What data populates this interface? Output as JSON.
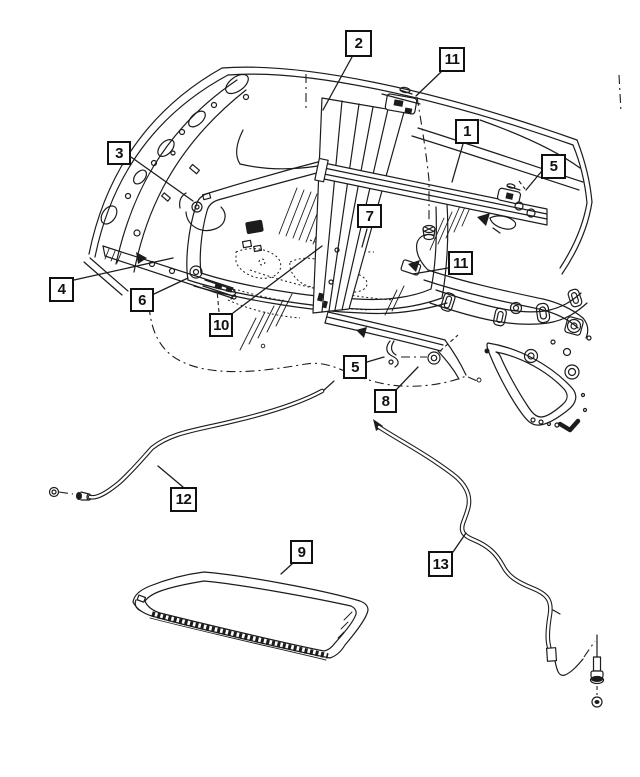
{
  "figure": {
    "title": "Sunroof and roof panel exploded parts diagram",
    "background_color": "#ffffff",
    "line_color": "#1c1c1c",
    "callout_border_color": "#111111"
  },
  "callouts": [
    {
      "id": "2",
      "label": "2"
    },
    {
      "id": "11-top",
      "label": "11"
    },
    {
      "id": "1",
      "label": "1"
    },
    {
      "id": "3",
      "label": "3"
    },
    {
      "id": "5-upper",
      "label": "5"
    },
    {
      "id": "7",
      "label": "7"
    },
    {
      "id": "11-mid",
      "label": "11"
    },
    {
      "id": "4",
      "label": "4"
    },
    {
      "id": "6",
      "label": "6"
    },
    {
      "id": "10",
      "label": "10"
    },
    {
      "id": "5-lower",
      "label": "5"
    },
    {
      "id": "8",
      "label": "8"
    },
    {
      "id": "12",
      "label": "12"
    },
    {
      "id": "9",
      "label": "9"
    },
    {
      "id": "13",
      "label": "13"
    }
  ]
}
